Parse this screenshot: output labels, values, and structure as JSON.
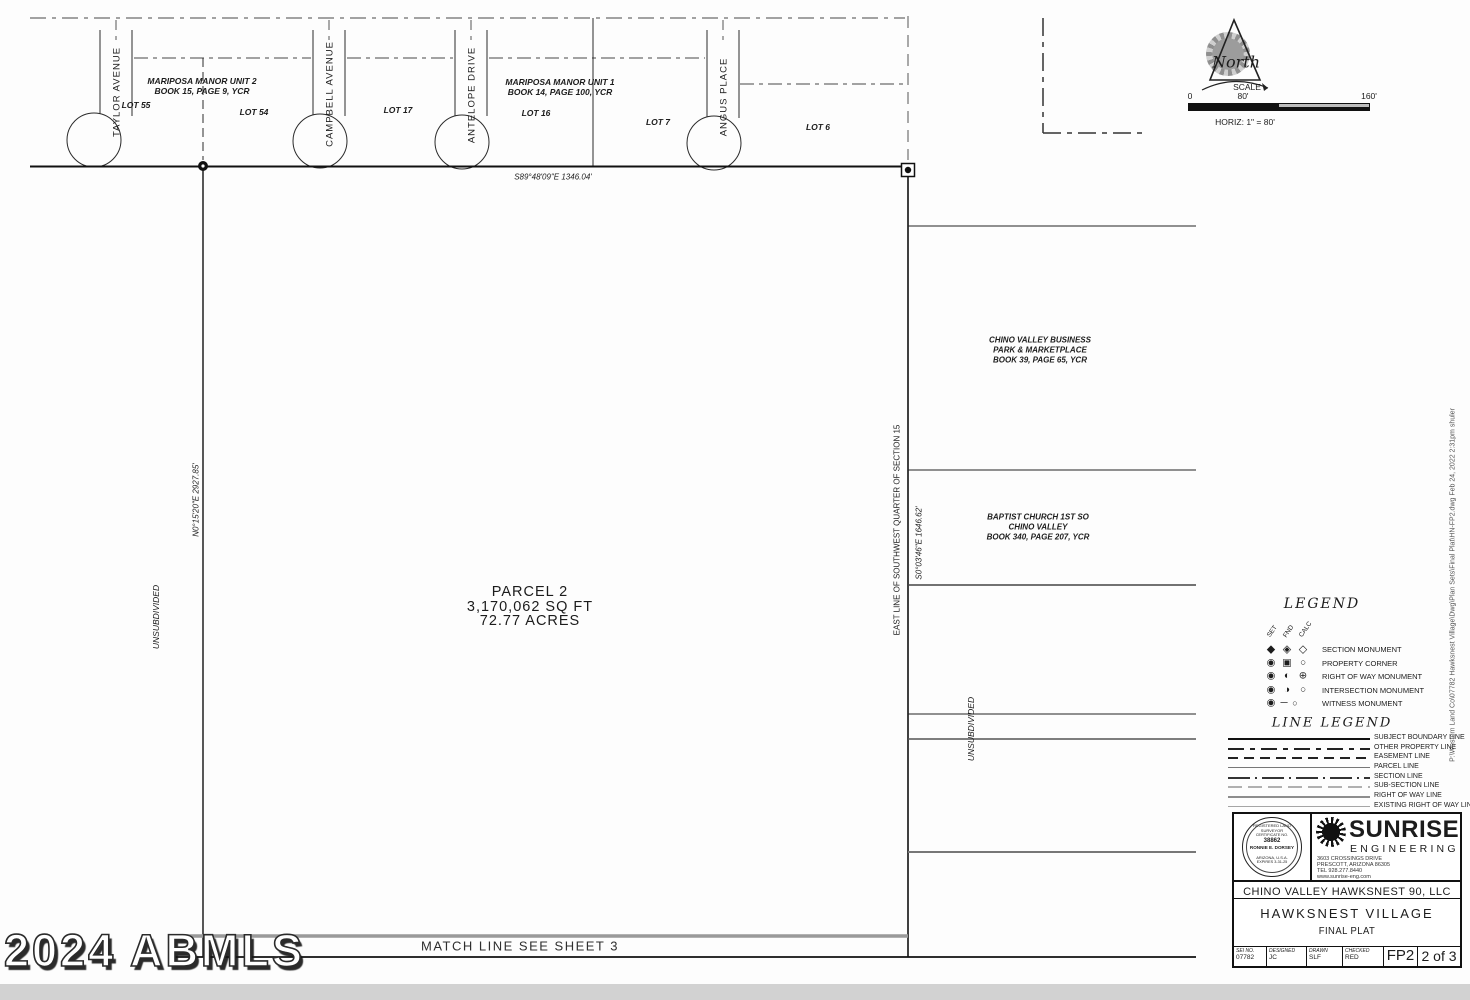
{
  "sheet": {
    "watermark": "2024 ABMLS",
    "file_path": "P:\\Western Land Co\\07782 Hawksnest Village\\Dwg\\Plan Sets\\Final Plat\\HN-FP2.dwg Feb 24, 2022 2:31pm shuler"
  },
  "north": {
    "label": "North"
  },
  "scale": {
    "title": "SCALE",
    "tick0": "0",
    "tick80": "80'",
    "tick160": "160'",
    "horiz": "HORIZ: 1\" = 80'"
  },
  "plat": {
    "streets": {
      "taylor": "TAYLOR AVENUE",
      "campbell": "CAMPBELL AVENUE",
      "antelope": "ANTELOPE DRIVE",
      "angus": "ANGUS PLACE"
    },
    "subdivision2": {
      "name": "MARIPOSA MANOR UNIT 2",
      "book": "BOOK 15, PAGE 9, YCR"
    },
    "subdivision1": {
      "name": "MARIPOSA MANOR UNIT 1",
      "book": "BOOK 14, PAGE 100, YCR"
    },
    "lots": {
      "l55": "LOT 55",
      "l54": "LOT 54",
      "l17": "LOT 17",
      "l16": "LOT 16",
      "l7": "LOT 7",
      "l6": "LOT 6"
    },
    "bearing_north_line": "S89°48'09\"E  1346.04'",
    "bearing_west_line": "N0°15'20\"E  2927.85'",
    "bearing_east_line": "S0°03'46\"E  1646.62'",
    "east_line_label": "EAST LINE OF SOUTHWEST QUARTER OF SECTION 15",
    "unsubdivided_west": "UNSUBDIVIDED",
    "unsubdivided_east": "UNSUBDIVIDED",
    "parcel": {
      "name": "PARCEL 2",
      "area_sqft": "3,170,062 SQ FT",
      "area_acres": "72.77 ACRES"
    },
    "neighbor_business": {
      "line1": "CHINO VALLEY BUSINESS",
      "line2": "PARK & MARKETPLACE",
      "line3": "BOOK 39, PAGE 65, YCR"
    },
    "neighbor_church": {
      "line1": "BAPTIST CHURCH 1ST SO",
      "line2": "CHINO VALLEY",
      "line3": "BOOK 340, PAGE 207, YCR"
    },
    "match_line": "MATCH LINE  SEE SHEET 3"
  },
  "legend": {
    "title": "LEGEND",
    "columns": {
      "set": "SET",
      "fnd": "FND",
      "calc": "CALC"
    },
    "rows": [
      {
        "s1": "◆",
        "s2": "◈",
        "s3": "◇",
        "label": "SECTION MONUMENT"
      },
      {
        "s1": "◉",
        "s2": "▣",
        "s3": "○",
        "label": "PROPERTY CORNER"
      },
      {
        "s1": "◉",
        "s2": "◐",
        "s3": "⊕",
        "label": "RIGHT OF WAY MONUMENT"
      },
      {
        "s1": "◉",
        "s2": "◑",
        "s3": "○",
        "label": "INTERSECTION MONUMENT"
      },
      {
        "s1": "◉",
        "s2": "─",
        "s3": "○",
        "label": "WITNESS MONUMENT"
      }
    ]
  },
  "line_legend": {
    "title": "LINE LEGEND",
    "rows": [
      "SUBJECT BOUNDARY LINE",
      "OTHER PROPERTY LINE",
      "EASEMENT LINE",
      "PARCEL LINE",
      "SECTION LINE",
      "SUB-SECTION LINE",
      "RIGHT OF WAY LINE",
      "EXISTING RIGHT OF WAY LINE"
    ]
  },
  "title_block": {
    "firm_name": "SUNRISE",
    "firm_sub": "ENGINEERING",
    "address1": "3603 CROSSINGS DRIVE",
    "address2": "PRESCOTT, ARIZONA 86305",
    "address3": "TEL 928.277.8440",
    "address4": "www.sunrise-eng.com",
    "client": "CHINO VALLEY HAWKSNEST 90, LLC",
    "project": "HAWKSNEST VILLAGE",
    "doc_type": "FINAL PLAT",
    "fields": [
      {
        "label": "SEI NO.",
        "value": "07782"
      },
      {
        "label": "DESIGNED",
        "value": "JC"
      },
      {
        "label": "DRAWN",
        "value": "SLF"
      },
      {
        "label": "CHECKED",
        "value": "RED"
      }
    ],
    "sheet_code": "FP2",
    "sheet_number": "2 of 3",
    "seal": {
      "arc_top": "REGISTERED LAND SURVEYOR",
      "cert": "CERTIFICATE NO.",
      "number": "38862",
      "name": "RONNIE E. DORSEY",
      "state": "ARIZONA, U.S.A.",
      "expires": "EXPIRES 3-31-25"
    }
  }
}
